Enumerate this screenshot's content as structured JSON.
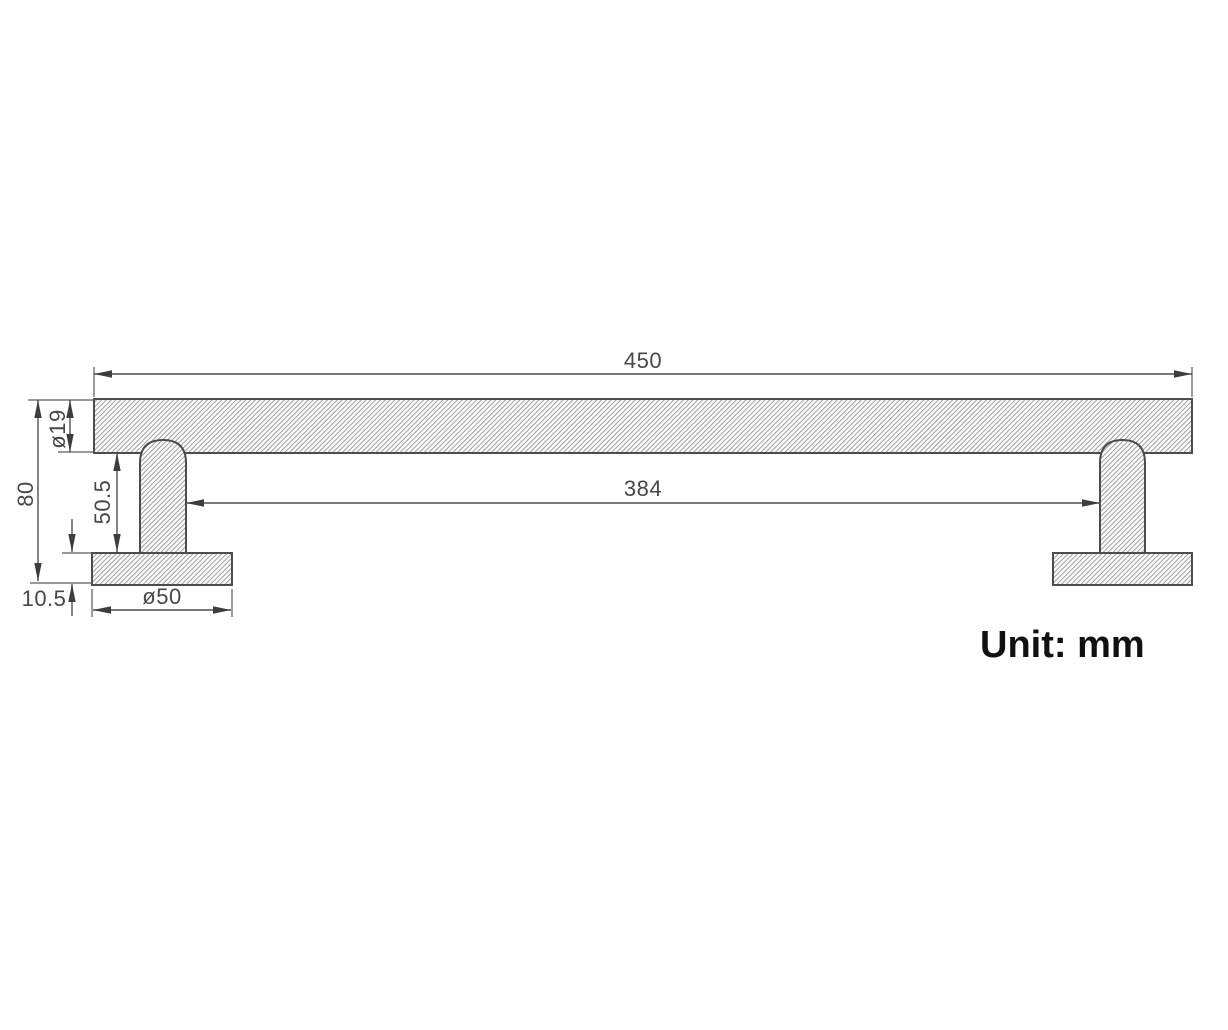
{
  "drawing": {
    "type": "technical-dimension-drawing",
    "subject": "wall-mounted towel bar side elevation",
    "unit_note": "Unit: mm",
    "line_color": "#4c4c4c",
    "hatch_color": "#9e9e9e",
    "text_color": "#474747",
    "dimensions": {
      "overall_length": "450",
      "inner_span": "384",
      "overall_height": "80",
      "bar_diameter": "ø19",
      "post_height": "50.5",
      "base_thickness": "10.5",
      "base_diameter": "ø50"
    }
  }
}
